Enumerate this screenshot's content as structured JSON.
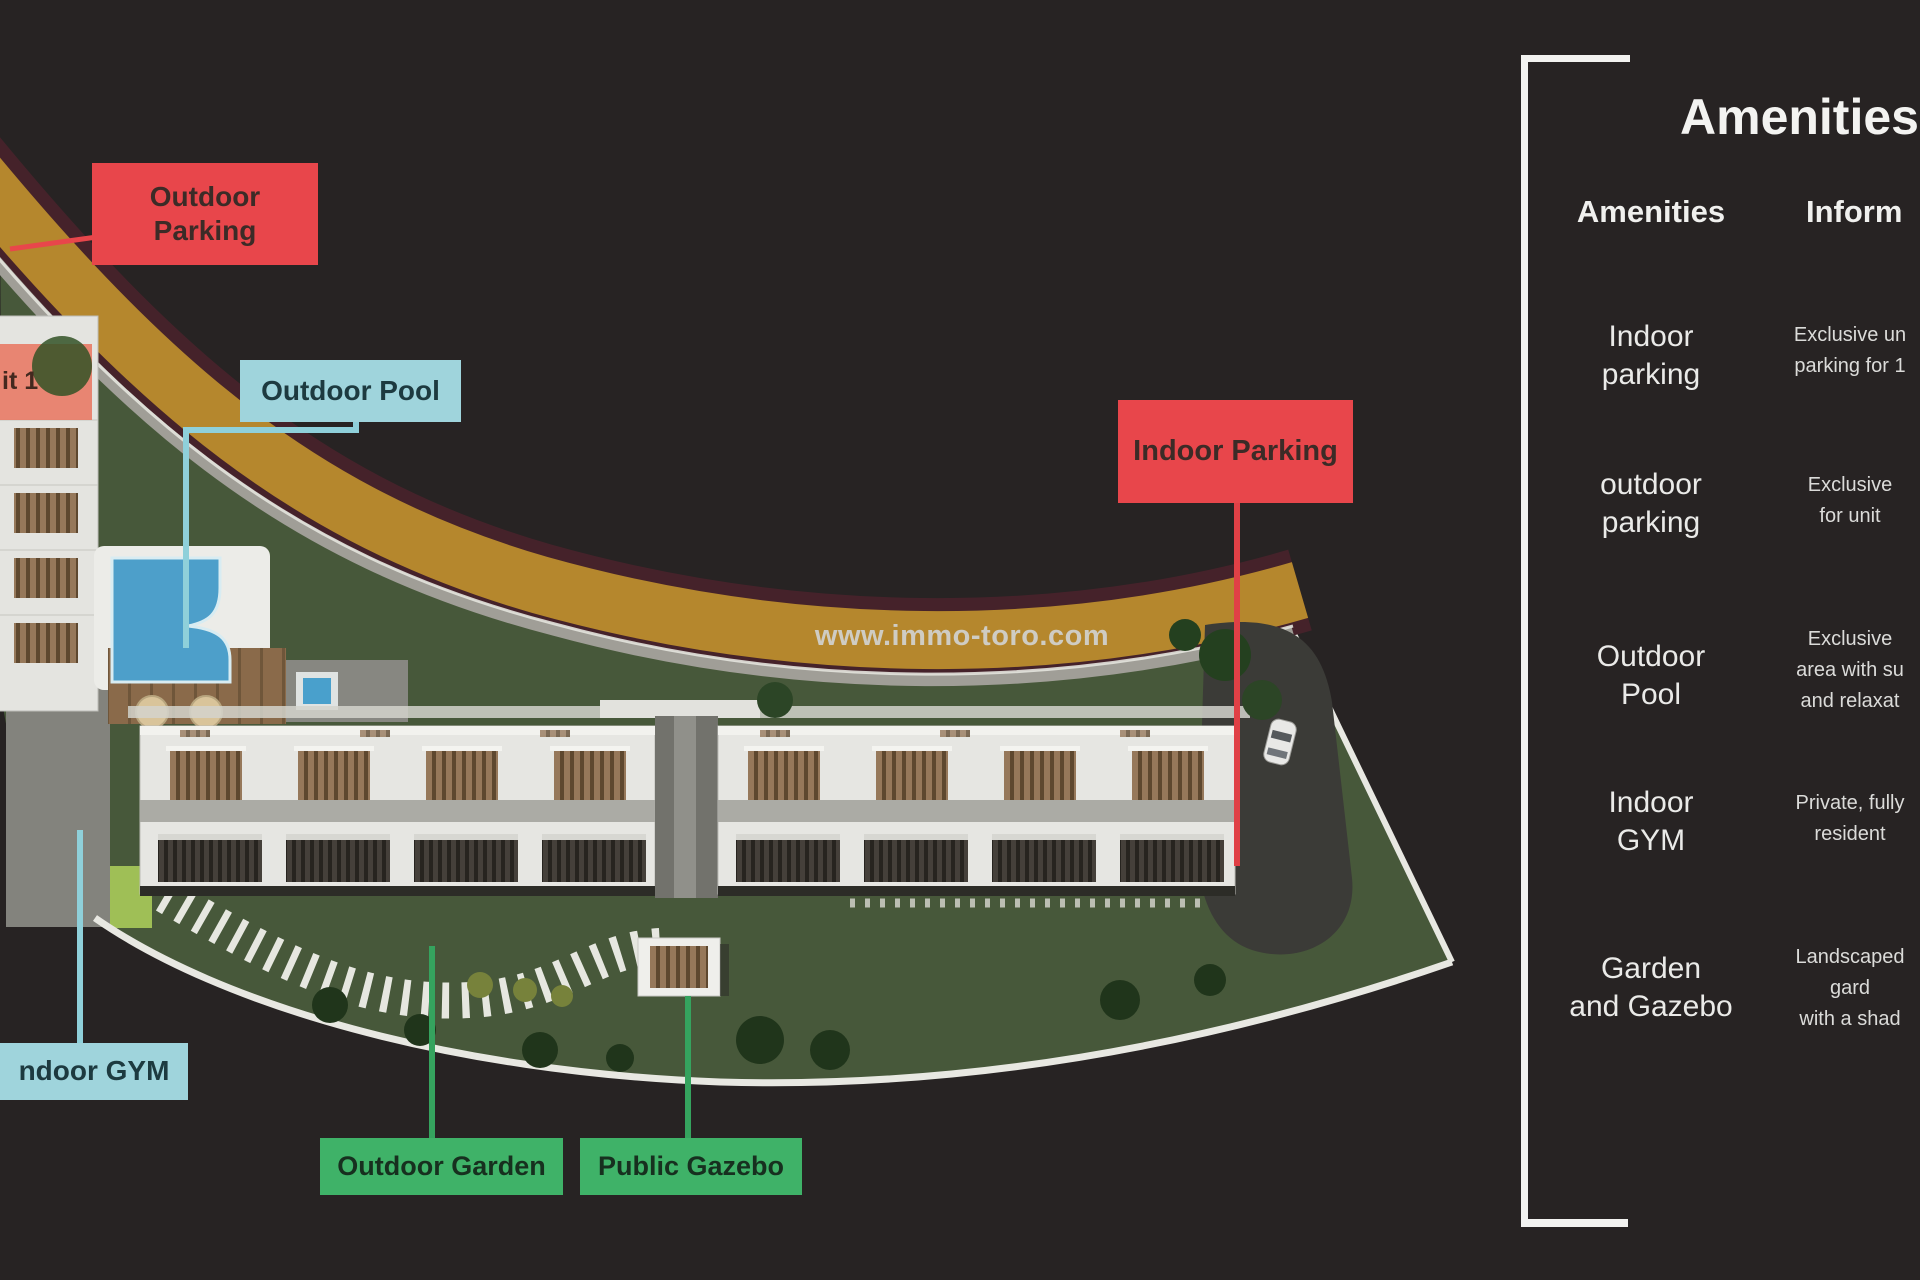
{
  "page": {
    "watermark": "www.immo-toro.com",
    "background_color": "#272323"
  },
  "map_labels": {
    "outdoor_parking": "Outdoor Parking",
    "outdoor_pool": "Outdoor Pool",
    "indoor_parking": "Indoor Parking",
    "indoor_gym": "ndoor GYM",
    "outdoor_garden": "Outdoor Garden",
    "public_gazebo": "Public Gazebo",
    "unit_tag": "it 1"
  },
  "colors": {
    "parking_label": "#e8464b",
    "pool_gym_label": "#9fd4dc",
    "garden_gazebo_label": "#3fb268",
    "road": "#b5872d",
    "road_edge": "#45222a",
    "grass": "#47583a",
    "pool_water": "#4d9fca",
    "panel_line": "#f2f2f0"
  },
  "panel": {
    "title": "Amenities",
    "columns": [
      "Amenities",
      "Inform"
    ],
    "rows": [
      {
        "name_lines": [
          "Indoor",
          "parking"
        ],
        "info_lines": [
          "Exclusive un",
          "parking for 1",
          ""
        ]
      },
      {
        "name_lines": [
          "outdoor",
          "parking"
        ],
        "info_lines": [
          "Exclusive",
          "for unit",
          ""
        ]
      },
      {
        "name_lines": [
          "Outdoor",
          "Pool"
        ],
        "info_lines": [
          "Exclusive",
          "area with su",
          "and relaxat"
        ]
      },
      {
        "name_lines": [
          "Indoor",
          "GYM"
        ],
        "info_lines": [
          "Private, fully",
          "resident",
          ""
        ]
      },
      {
        "name_lines": [
          "Garden",
          "and Gazebo"
        ],
        "info_lines": [
          "Landscaped",
          "gard",
          "with a shad"
        ]
      }
    ]
  }
}
